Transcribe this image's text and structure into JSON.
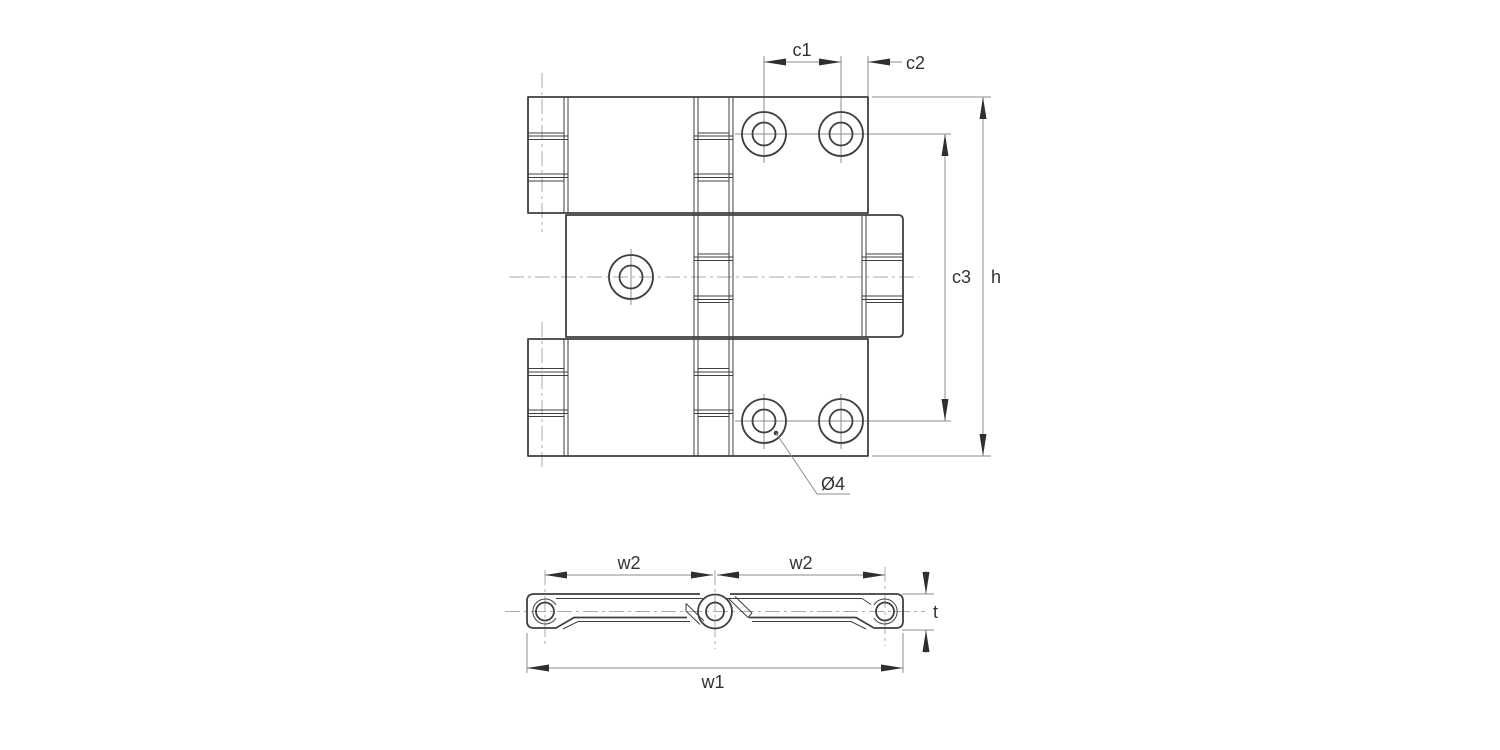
{
  "colors": {
    "bg": "#ffffff",
    "outline": "#3f3f3f",
    "dim": "#8e8e8e",
    "center": "#ababab",
    "arrow": "#2f2f2f",
    "text": "#333333"
  },
  "drawing": {
    "type": "technical-dimension-drawing",
    "views": {
      "top_view": "hinge top view",
      "side_view": "hinge side profile"
    },
    "dimensions": {
      "c1": "c1",
      "c2": "c2",
      "c3": "c3",
      "h": "h",
      "hole_dia": "Ø4",
      "w2_left": "w2",
      "w2_right": "w2",
      "w1": "w1",
      "t": "t"
    }
  }
}
